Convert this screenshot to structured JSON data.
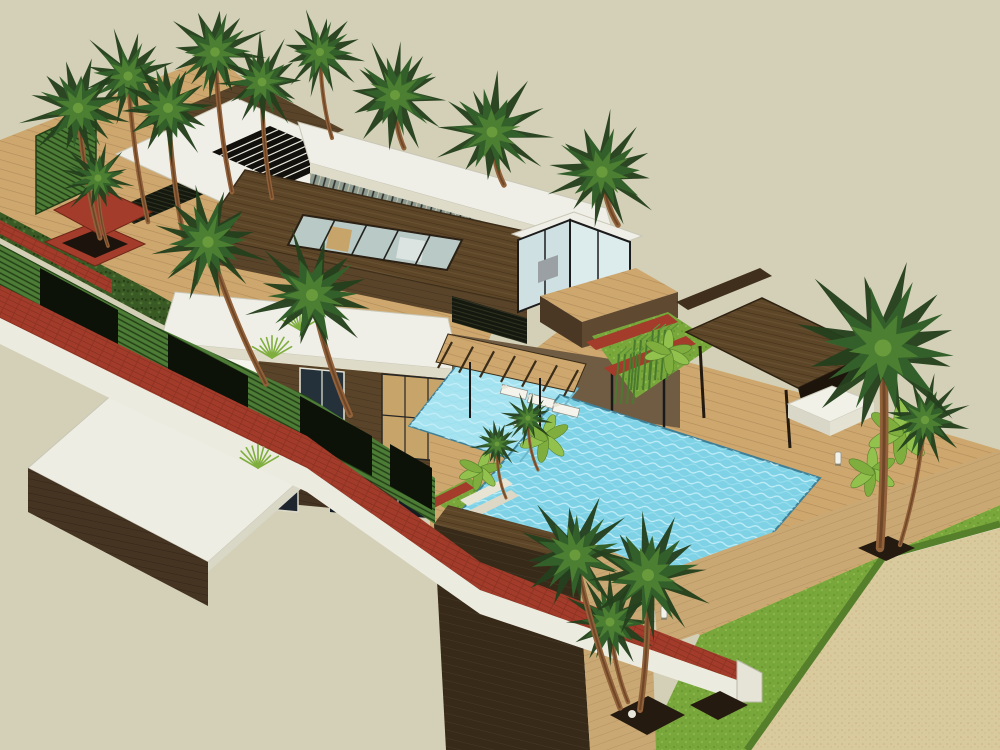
{
  "meta": {
    "description": "Aerial 3D architectural render of a modern two-storey tropical villa with flat white roofs, dark timber walls, courtyard atrium, swimming pool with loungers, cabana pavilion, palm trees, louvered boundary wall and lawn"
  },
  "palette": {
    "background": "#d3d0b7",
    "sand": "#d9ca9d",
    "sand_dot": "#c6b183",
    "kerb": "#ecebdf",
    "lawn": "#79a73c",
    "lawn_dark": "#567f2b",
    "deck_wood": "#cda76e",
    "roof_white": "#f0efe7",
    "roof_edge": "#dedcc9",
    "stucco": "#f5f4ec",
    "wood_roof": "#5d4527",
    "wood_wall": "#5a4429",
    "wood_dark": "#3a2b19",
    "wood_tan": "#c9a874",
    "brick_red": "#a23b2a",
    "brick_line": "#7e2c1e",
    "louver_green": "#4c7c36",
    "louver_line": "#223d15",
    "opening_dark": "#0d1208",
    "hedge": "#3a5a25",
    "pool_water": "#7fd2e6",
    "pool_ledge": "#a5e3f0",
    "pool_edge": "#3f7f96",
    "glass": "#cfe0e2",
    "glass_dark": "#25313a",
    "frame_dark": "#1c1c1c",
    "palm_dark": "#24401d",
    "palm_mid": "#33602a",
    "palm_light": "#4d7f33",
    "trunk": "#91613a",
    "lounger_white": "#f4f3ec",
    "daybed_white": "#f2f1e8",
    "planter_red": "#a33c2b",
    "bed_soil": "#241a10"
  },
  "scene": {
    "palms": [
      {
        "x": 78,
        "y": 108,
        "r": 52,
        "bx": 100,
        "by": 238
      },
      {
        "x": 128,
        "y": 76,
        "r": 46,
        "bx": 148,
        "by": 222
      },
      {
        "x": 168,
        "y": 108,
        "r": 50,
        "bx": 186,
        "by": 248
      },
      {
        "x": 215,
        "y": 52,
        "r": 48,
        "bx": 232,
        "by": 192
      },
      {
        "x": 262,
        "y": 82,
        "r": 44,
        "bx": 272,
        "by": 198
      },
      {
        "x": 98,
        "y": 178,
        "r": 36,
        "bx": 108,
        "by": 246
      },
      {
        "x": 320,
        "y": 52,
        "r": 40,
        "bx": 332,
        "by": 138
      },
      {
        "x": 395,
        "y": 95,
        "r": 50,
        "bx": 404,
        "by": 148
      },
      {
        "x": 492,
        "y": 132,
        "r": 54,
        "bx": 504,
        "by": 185
      },
      {
        "x": 602,
        "y": 172,
        "r": 56,
        "bx": 618,
        "by": 225
      },
      {
        "x": 208,
        "y": 242,
        "r": 56,
        "bx": 266,
        "by": 384
      },
      {
        "x": 312,
        "y": 295,
        "r": 60,
        "bx": 350,
        "by": 415
      },
      {
        "x": 528,
        "y": 418,
        "r": 26,
        "bx": 538,
        "by": 470
      },
      {
        "x": 497,
        "y": 444,
        "r": 24,
        "bx": 506,
        "by": 498
      },
      {
        "x": 575,
        "y": 555,
        "r": 55,
        "bx": 620,
        "by": 708
      },
      {
        "x": 648,
        "y": 575,
        "r": 60,
        "bx": 640,
        "by": 710
      },
      {
        "x": 610,
        "y": 622,
        "r": 45,
        "bx": 628,
        "by": 702
      },
      {
        "x": 883,
        "y": 348,
        "r": 85,
        "bx": 880,
        "by": 548
      },
      {
        "x": 925,
        "y": 420,
        "r": 42,
        "bx": 900,
        "by": 545
      }
    ],
    "bananas": [
      {
        "x": 545,
        "y": 438,
        "r": 26
      },
      {
        "x": 480,
        "y": 470,
        "r": 22
      },
      {
        "x": 668,
        "y": 352,
        "r": 24
      },
      {
        "x": 900,
        "y": 432,
        "r": 34
      },
      {
        "x": 872,
        "y": 472,
        "r": 26
      }
    ],
    "bamboo": [
      {
        "x": 640,
        "y": 352
      },
      {
        "x": 658,
        "y": 342
      },
      {
        "x": 624,
        "y": 366
      }
    ],
    "grass_tufts": [
      {
        "x": 272,
        "y": 358
      },
      {
        "x": 258,
        "y": 468
      },
      {
        "x": 300,
        "y": 330
      }
    ],
    "loungers": [
      {
        "x": 514,
        "y": 392,
        "angle": 14
      },
      {
        "x": 541,
        "y": 401,
        "angle": 14
      },
      {
        "x": 566,
        "y": 410,
        "angle": 14
      },
      {
        "x": 527,
        "y": 424,
        "angle": 14
      }
    ],
    "sconces": [
      {
        "x": 664,
        "y": 612
      },
      {
        "x": 838,
        "y": 458
      }
    ],
    "bridge": {
      "x1": 452,
      "y1": 342,
      "x2": 578,
      "y2": 370,
      "n": 7,
      "dx": -14,
      "dy": 26
    },
    "grille": {
      "p0": [
        212,
        152
      ],
      "p1": [
        270,
        126
      ],
      "p2": [
        344,
        158
      ],
      "p3": [
        286,
        184
      ],
      "n": 9
    },
    "atrium_frames": {
      "top1": [
        303,
        215
      ],
      "top2": [
        462,
        240
      ],
      "bot1": [
        288,
        245
      ],
      "bot2": [
        447,
        270
      ],
      "n": 5
    }
  }
}
